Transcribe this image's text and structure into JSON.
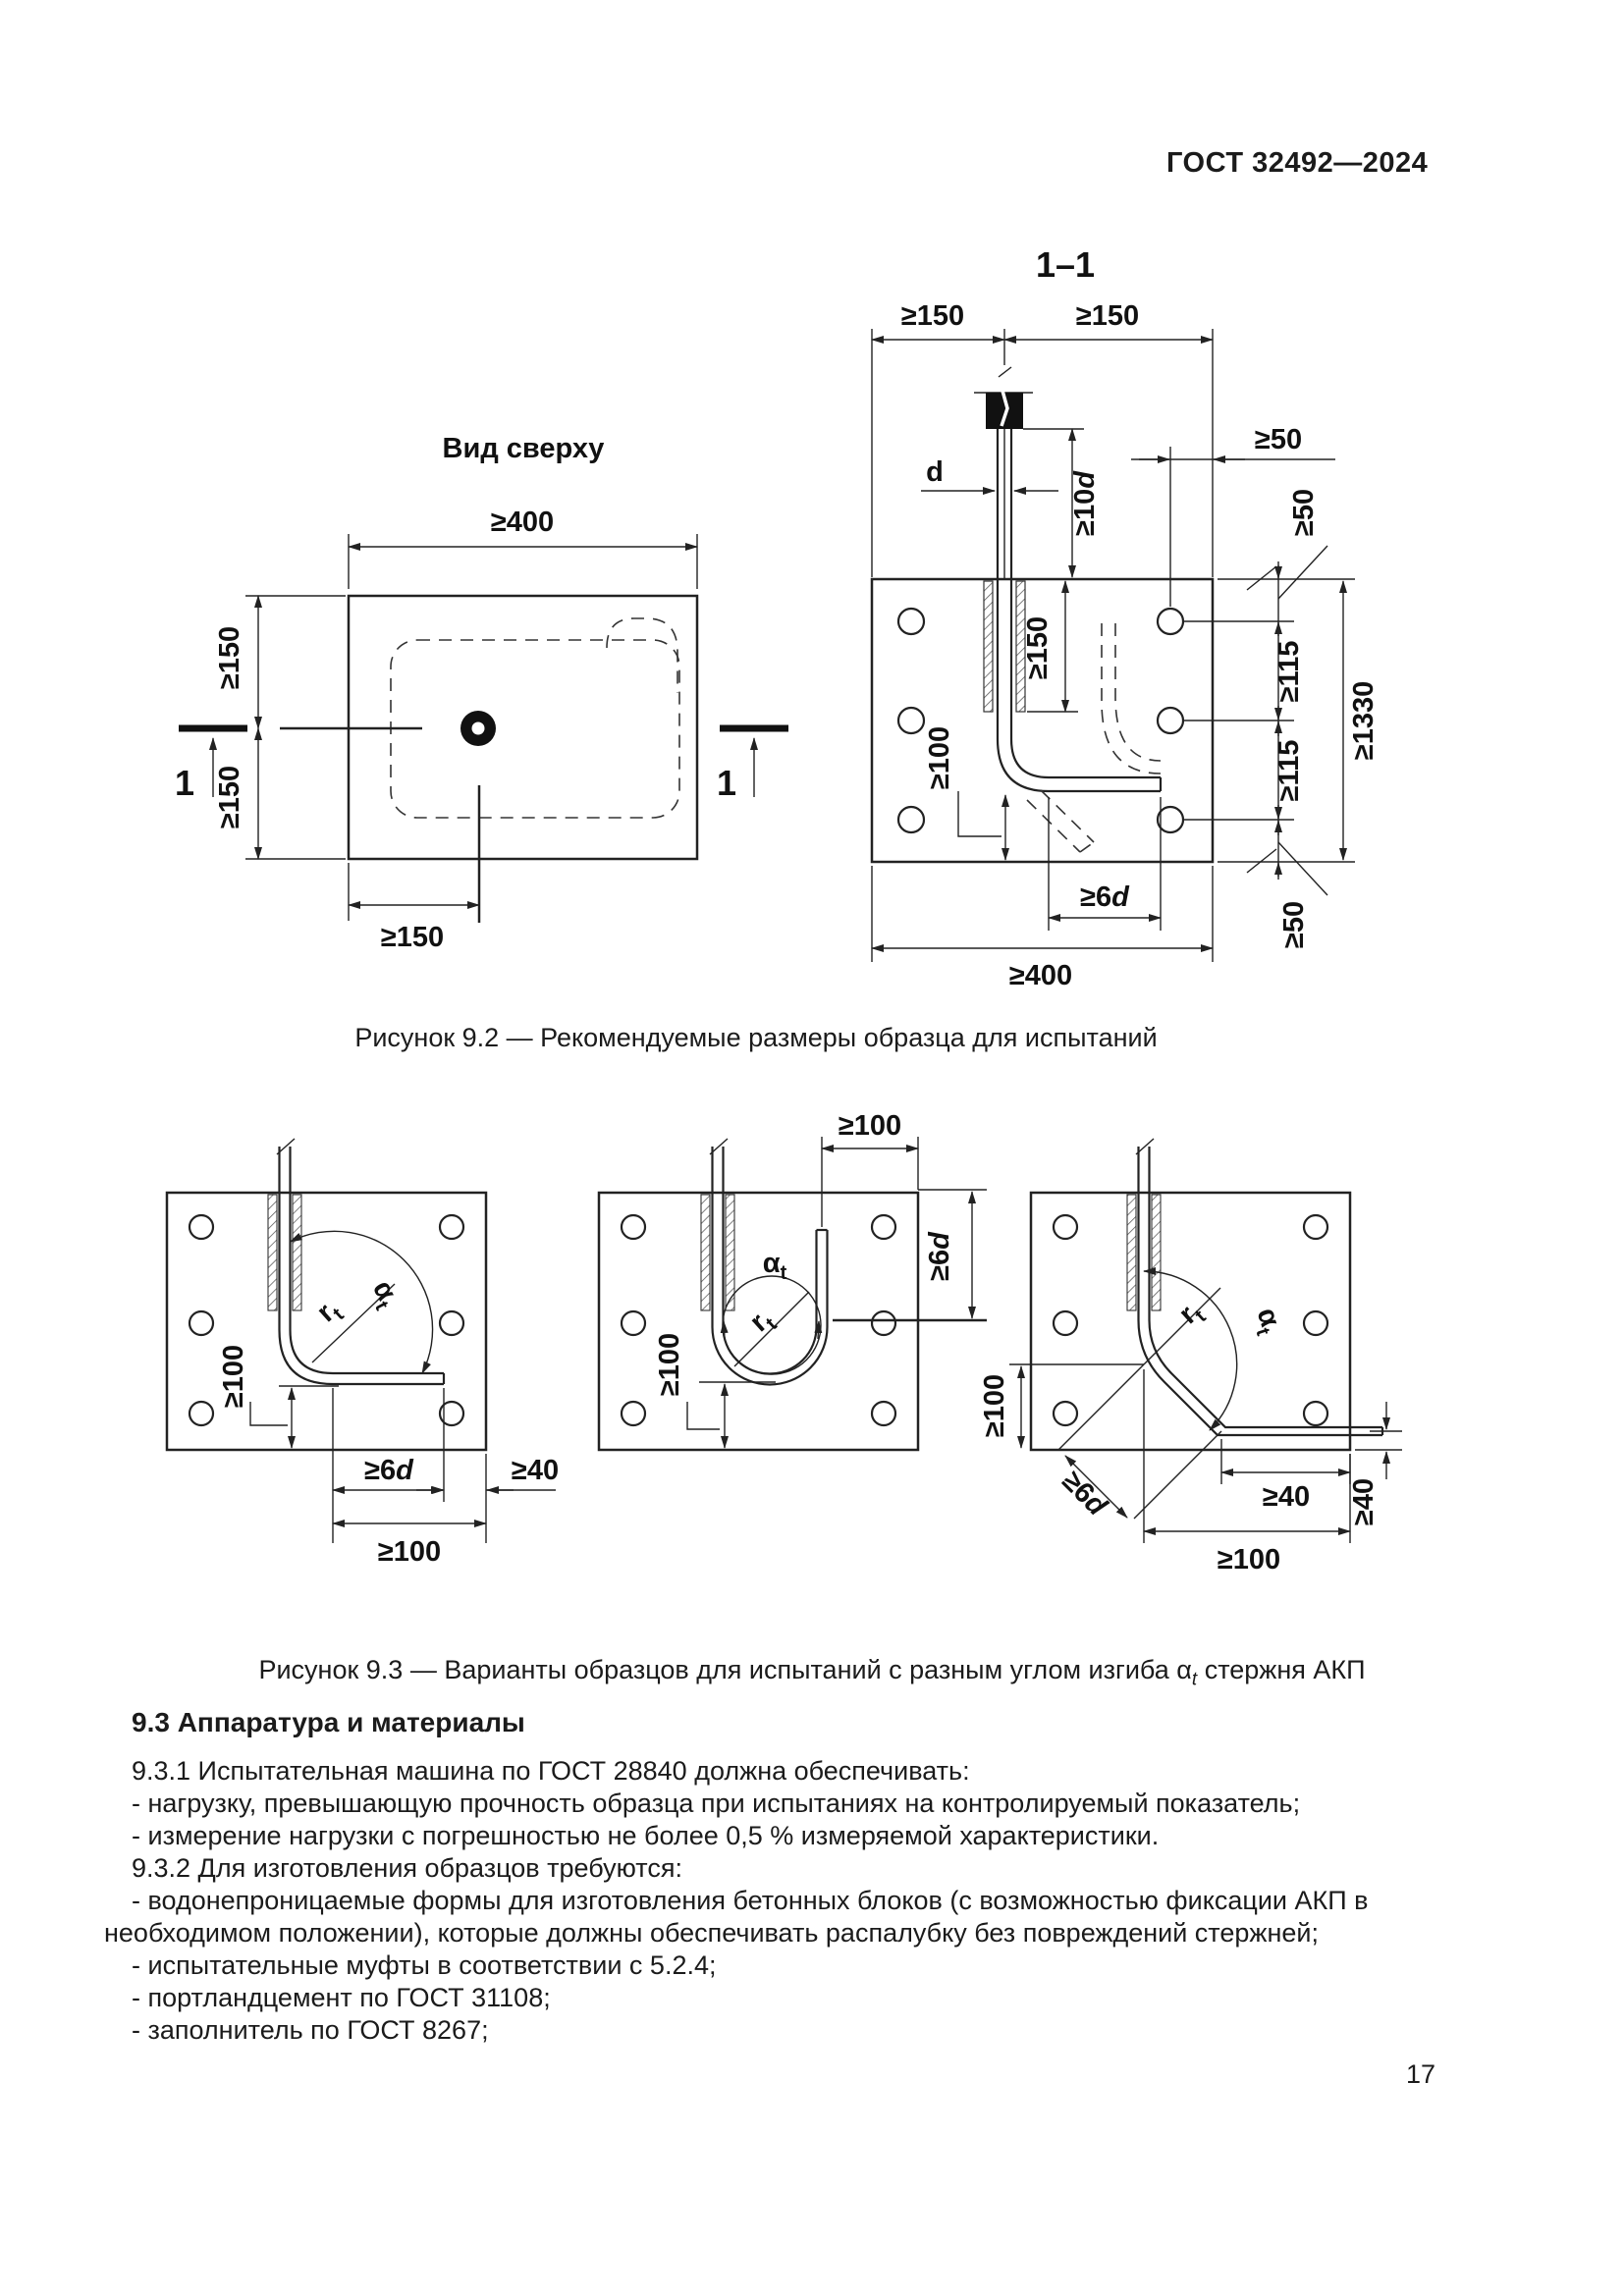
{
  "header": {
    "doc_number": "ГОСТ 32492—2024"
  },
  "page": {
    "number": "17"
  },
  "fig92": {
    "section_label": "1–1",
    "caption": "Рисунок 9.2 — Рекомендуемые размеры образца для испытаний",
    "top_view": {
      "title": "Вид сверху",
      "dim_width": "≥400",
      "dim_left_top": "≥150",
      "dim_left_bottom": "≥150",
      "dim_bottom": "≥150",
      "marker_left": "1",
      "marker_right": "1"
    },
    "section_view": {
      "dim_top_left": "≥150",
      "dim_top_right": "≥150",
      "dim_rod_diameter": "d",
      "dim_anchor_main": "≥10",
      "dim_anchor_it": "d",
      "dim_hole_edge": "≥50",
      "dim_edge_top": "≥50",
      "dim_sleeve": "≥150",
      "dim_embed": "≥100",
      "dim_tail_main": "≥6",
      "dim_tail_it": "d",
      "dim_width": "≥400",
      "dim_spacing1": "≥115",
      "dim_spacing2": "≥115",
      "dim_total": "≥1330",
      "dim_edge_bottom": "≥50"
    }
  },
  "fig93": {
    "caption_prefix": "Рисунок 9.3 — Варианты образцов для испытаний с разным углом изгиба α",
    "caption_sub": "t",
    "caption_suffix": " стержня АКП",
    "v90": {
      "alpha": "α",
      "alpha_sub": "t",
      "r": "r",
      "r_sub": "t",
      "dim_embed": "≥100",
      "dim_tail_main": "≥6",
      "dim_tail_it": "d",
      "dim_edge": "≥40",
      "dim_bottom": "≥100"
    },
    "v180": {
      "alpha": "α",
      "alpha_sub": "t",
      "r": "r",
      "r_sub": "t",
      "dim_top": "≥100",
      "dim_tail_main": "≥6",
      "dim_tail_it": "d",
      "dim_embed": "≥100"
    },
    "v135": {
      "alpha": "α",
      "alpha_sub": "t",
      "r": "r",
      "r_sub": "t",
      "dim_embed": "≥100",
      "dim_tail_main": "≥6",
      "dim_tail_it": "d",
      "dim_edge": "≥40",
      "dim_edge_right": "≥40",
      "dim_bottom": "≥100"
    }
  },
  "section93": {
    "heading": "9.3 Аппаратура и материалы",
    "p931": "9.3.1 Испытательная машина по ГОСТ 28840 должна обеспечивать:",
    "li1": "- нагрузку, превышающую прочность образца при испытаниях на контролируемый показатель;",
    "li2": "- измерение нагрузки с погрешностью не более 0,5 % измеряемой характеристики.",
    "p932": "9.3.2 Для изготовления образцов требуются:",
    "li3": "- водонепроницаемые формы для изготовления бетонных блоков (с возможностью фиксации АКП в необходимом положении), которые должны обеспечивать распалубку без повреждений стержней;",
    "li4": "- испытательные муфты в соответствии с 5.2.4;",
    "li5": "- портландцемент по ГОСТ 31108;",
    "li6": "- заполнитель по ГОСТ 8267;"
  }
}
